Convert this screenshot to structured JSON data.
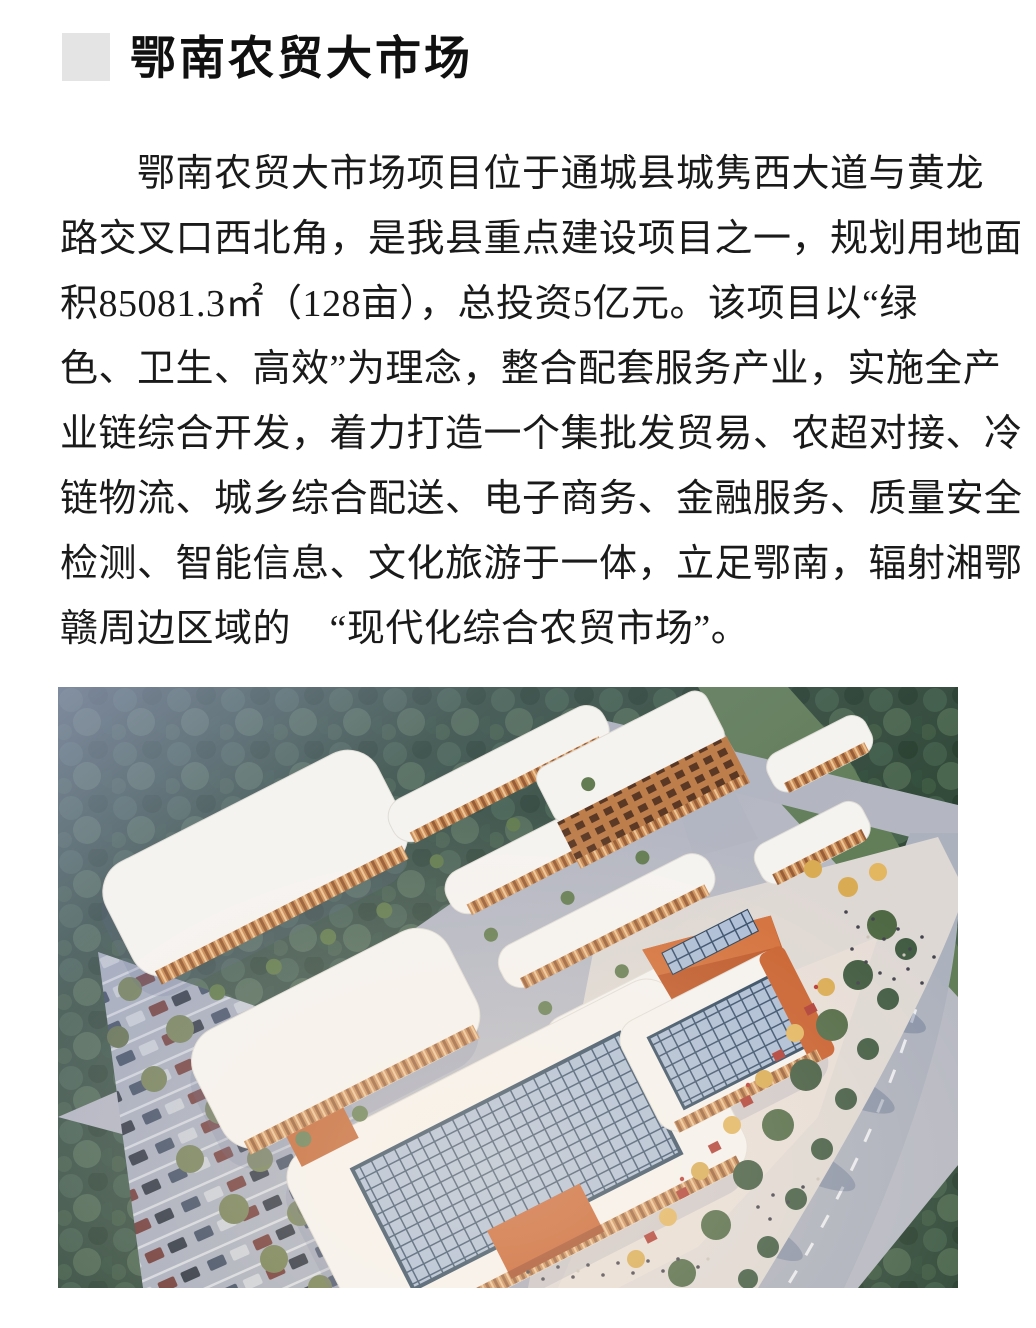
{
  "header": {
    "title": "鄂南农贸大市场"
  },
  "paragraph": {
    "lines": [
      "鄂南农贸大市场项目位于通城县城隽西大道与黄龙",
      "路交叉口西北角，是我县重点建设项目之一，规划用地面",
      "积85081.3㎡（128亩），总投资5亿元。该项目以“绿",
      "色、卫生、高效”为理念，整合配套服务产业，实施全产",
      "业链综合开发，着力打造一个集批发贸易、农超对接、冷",
      "链物流、城乡综合配送、电子商务、金融服务、质量安全",
      "检测、智能信息、文化旅游于一体，立足鄂南，辐射湘鄂",
      "赣周边区域的　“现代化综合农贸市场”。"
    ]
  },
  "figure": {
    "alt": "鄂南农贸大市场项目鸟瞰效果图",
    "palette": {
      "forest_green": "#2d4836",
      "haze_blue": "#9aa3c8",
      "roof_white": "#f5f3f0",
      "facade_orange": "#cf8a4e",
      "accent_orange": "#cf5a22",
      "skylight_glass": "#a8bcd8",
      "skylight_frame": "#2c4868",
      "road_gray": "#aab0bd",
      "plaza_warm": "#e2dad4",
      "tree_olive": "#6d7b49"
    }
  }
}
